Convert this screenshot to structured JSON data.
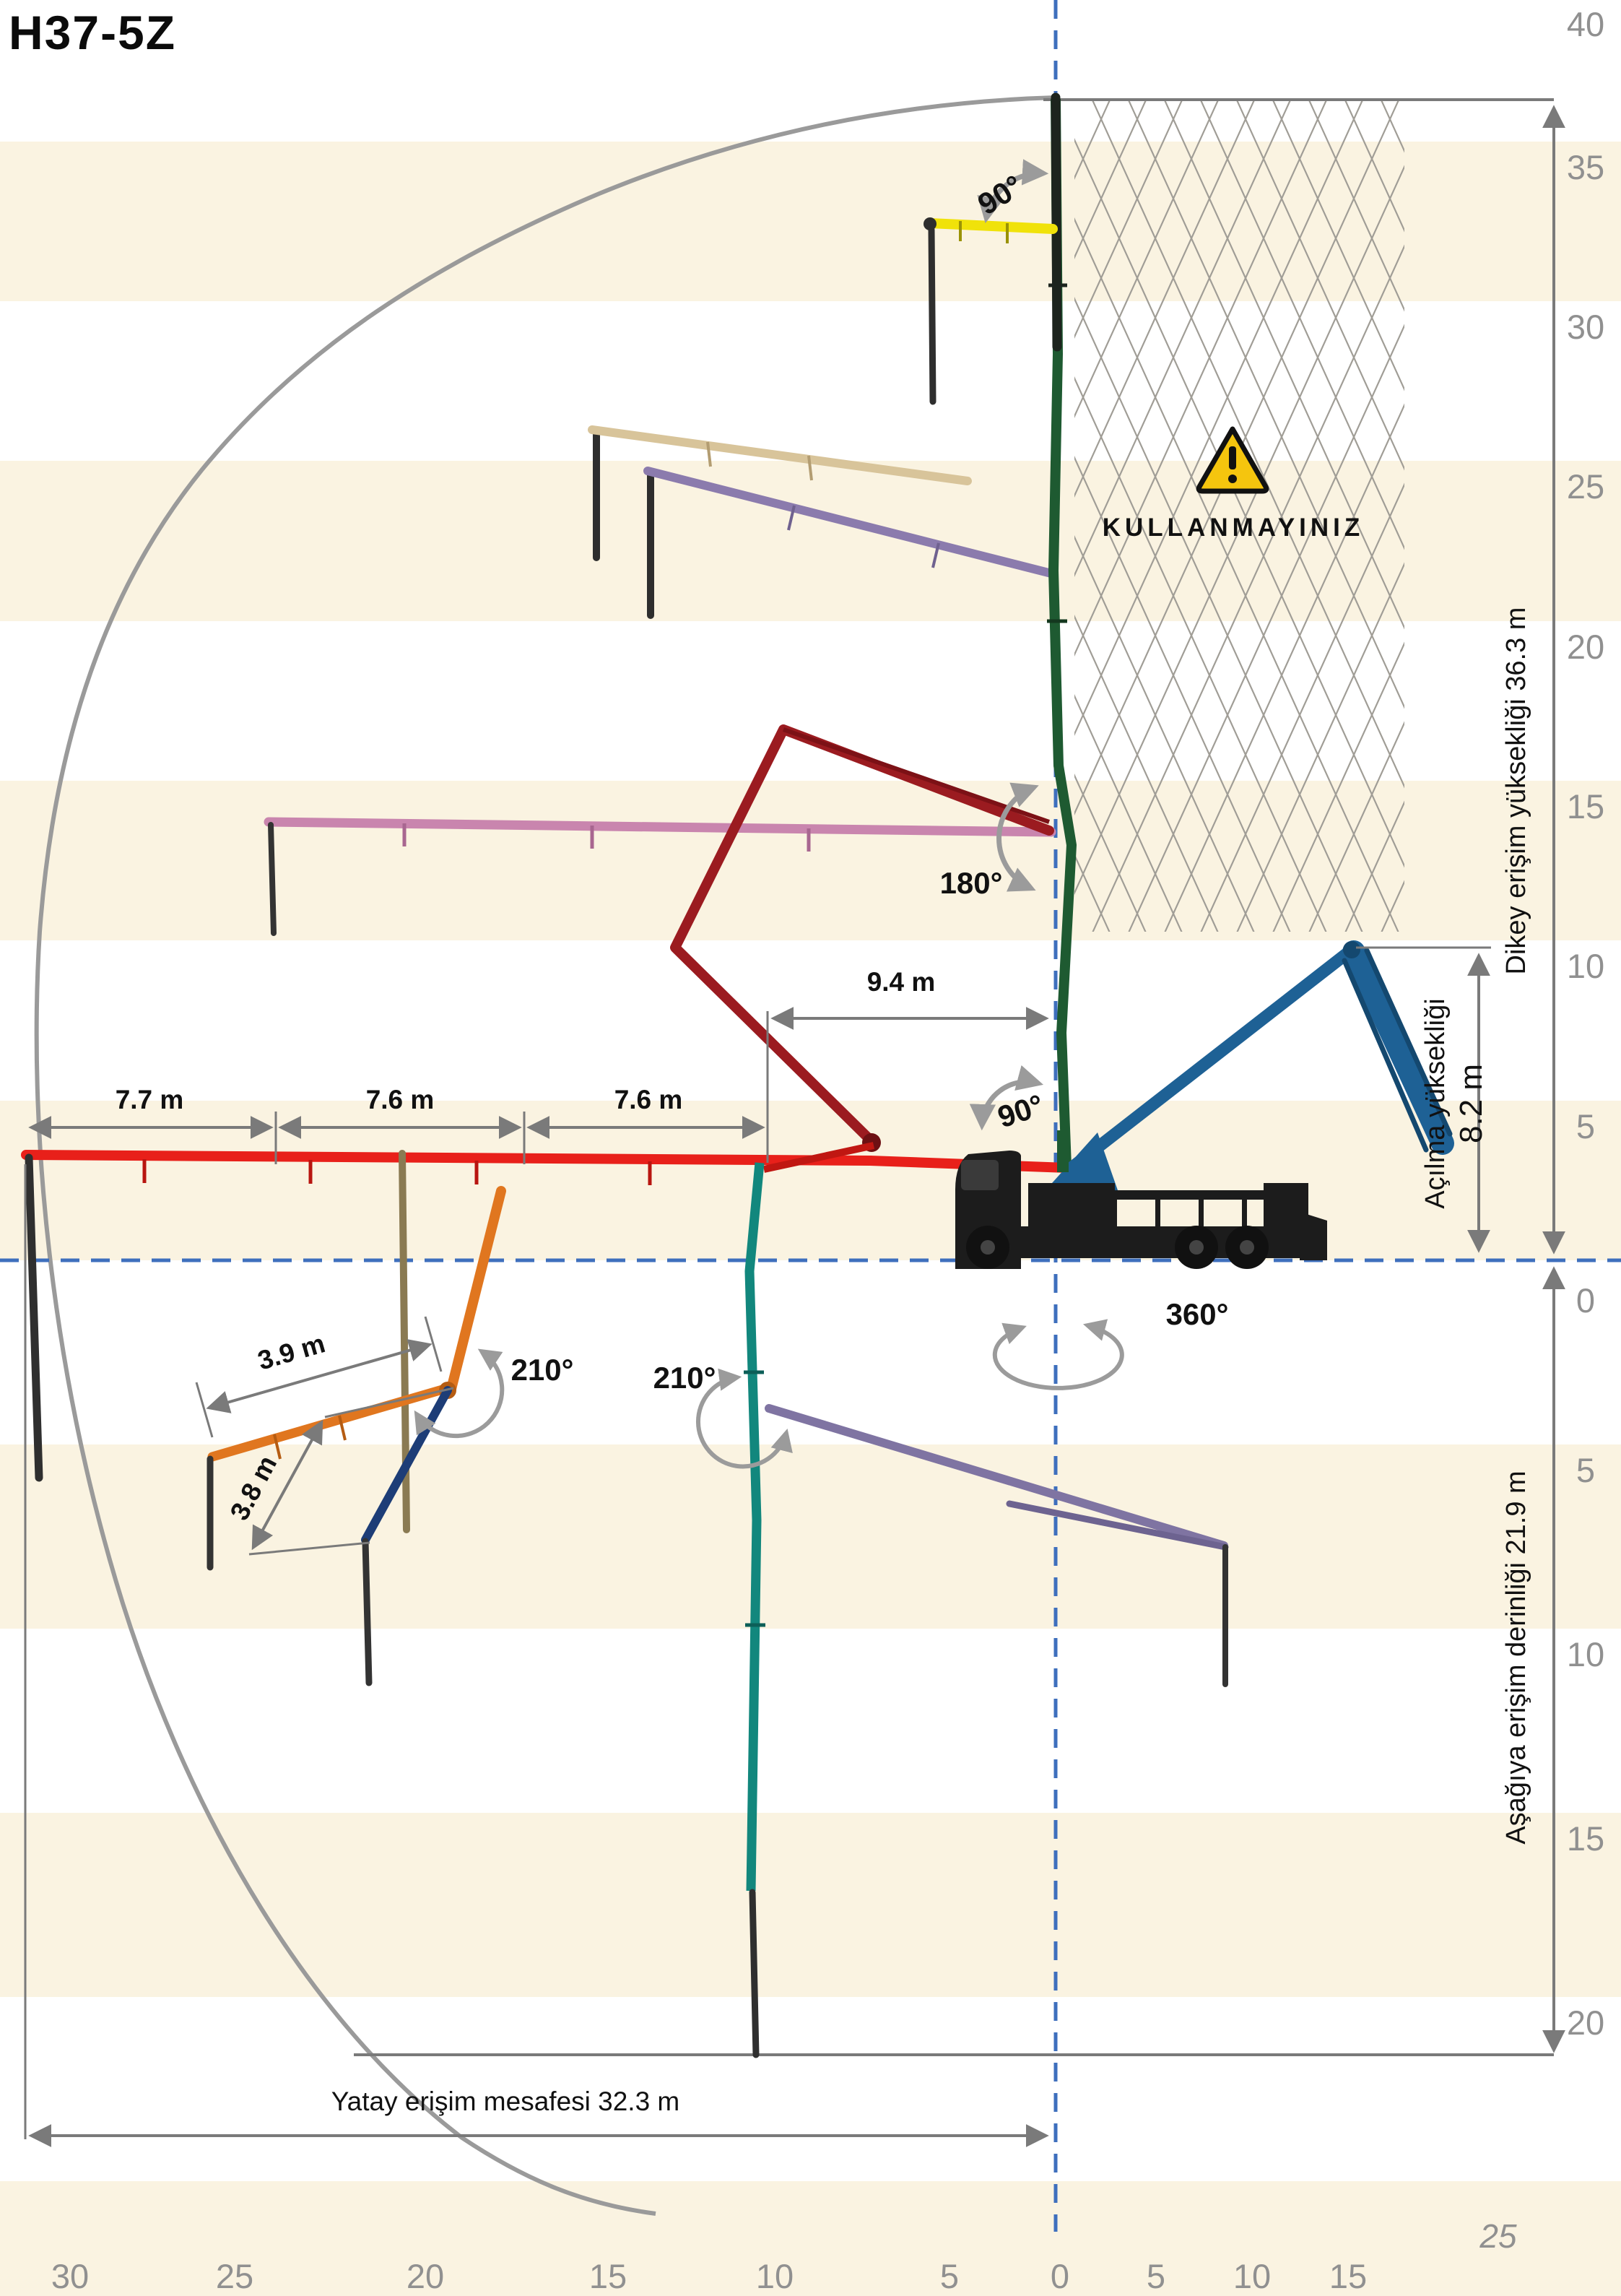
{
  "title": "H37-5Z",
  "warning": {
    "text": "KULLANMAYINIZ"
  },
  "angles": {
    "boom_tip_90": "90°",
    "fold_180": "180°",
    "unfold_90": "90°",
    "slew_360": "360°",
    "orange_210": "210°",
    "teal_210": "210°"
  },
  "dimensions": {
    "d_9_4": "9.4 m",
    "d_7_7": "7.7 m",
    "d_7_6_a": "7.6 m",
    "d_7_6_b": "7.6 m",
    "d_3_9": "3.9 m",
    "d_3_8": "3.8 m",
    "unfold_height_label": "Açılma yüksekliği",
    "unfold_height_value": "8.2 m"
  },
  "labels": {
    "vertical_reach": "Dikey erişim yüksekliği 36.3 m",
    "downward_reach": "Aşağıya erişim derinliği 21.9 m",
    "horizontal_reach": "Yatay erişim mesafesi 32.3 m"
  },
  "axes": {
    "right_above": [
      "40",
      "35",
      "30",
      "25",
      "20",
      "15",
      "10",
      "5",
      "0"
    ],
    "right_below": [
      "5",
      "10",
      "15",
      "20"
    ],
    "right_below_extra": "25",
    "bottom": [
      "30",
      "25",
      "20",
      "15",
      "10",
      "5",
      "0",
      "5",
      "10",
      "15"
    ]
  },
  "colors": {
    "stripe": "#faf3e1",
    "dash_blue": "#3e6fbd",
    "axis_gray": "#909090",
    "dim_gray": "#7a7a7a",
    "warning_yellow": "#f5c50e",
    "boom_red": "#e8201a",
    "boom_green": "#1e5a31",
    "boom_yellow": "#f0e20a",
    "boom_blue": "#1e6195",
    "boom_teal": "#12877d",
    "boom_orange": "#e0761f",
    "boom_maroon": "#9b1b20",
    "boom_pink": "#c985ae",
    "boom_tan": "#d8c49a",
    "boom_purple": "#8b7bad",
    "boom_navy": "#1d3d77",
    "boom_slate": "#7f74a2",
    "truck_black": "#1c1c1c"
  }
}
